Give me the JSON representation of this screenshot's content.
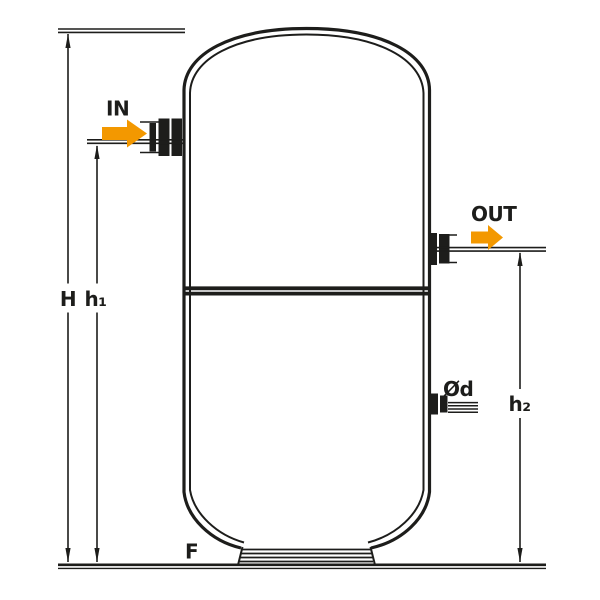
{
  "diagram": {
    "kind": "technical-dimension-drawing",
    "subject": "vertical storage tank with inlet and outlet connections",
    "labels": {
      "inlet": "IN",
      "outlet": "OUT",
      "total_height": "H",
      "inlet_height": "h₁",
      "outlet_height": "h₂",
      "port_diameter": "Ød",
      "foot": "F"
    },
    "colors": {
      "line": "#1d1d1b",
      "flow_arrow": "#f39800",
      "background": "#ffffff"
    }
  }
}
